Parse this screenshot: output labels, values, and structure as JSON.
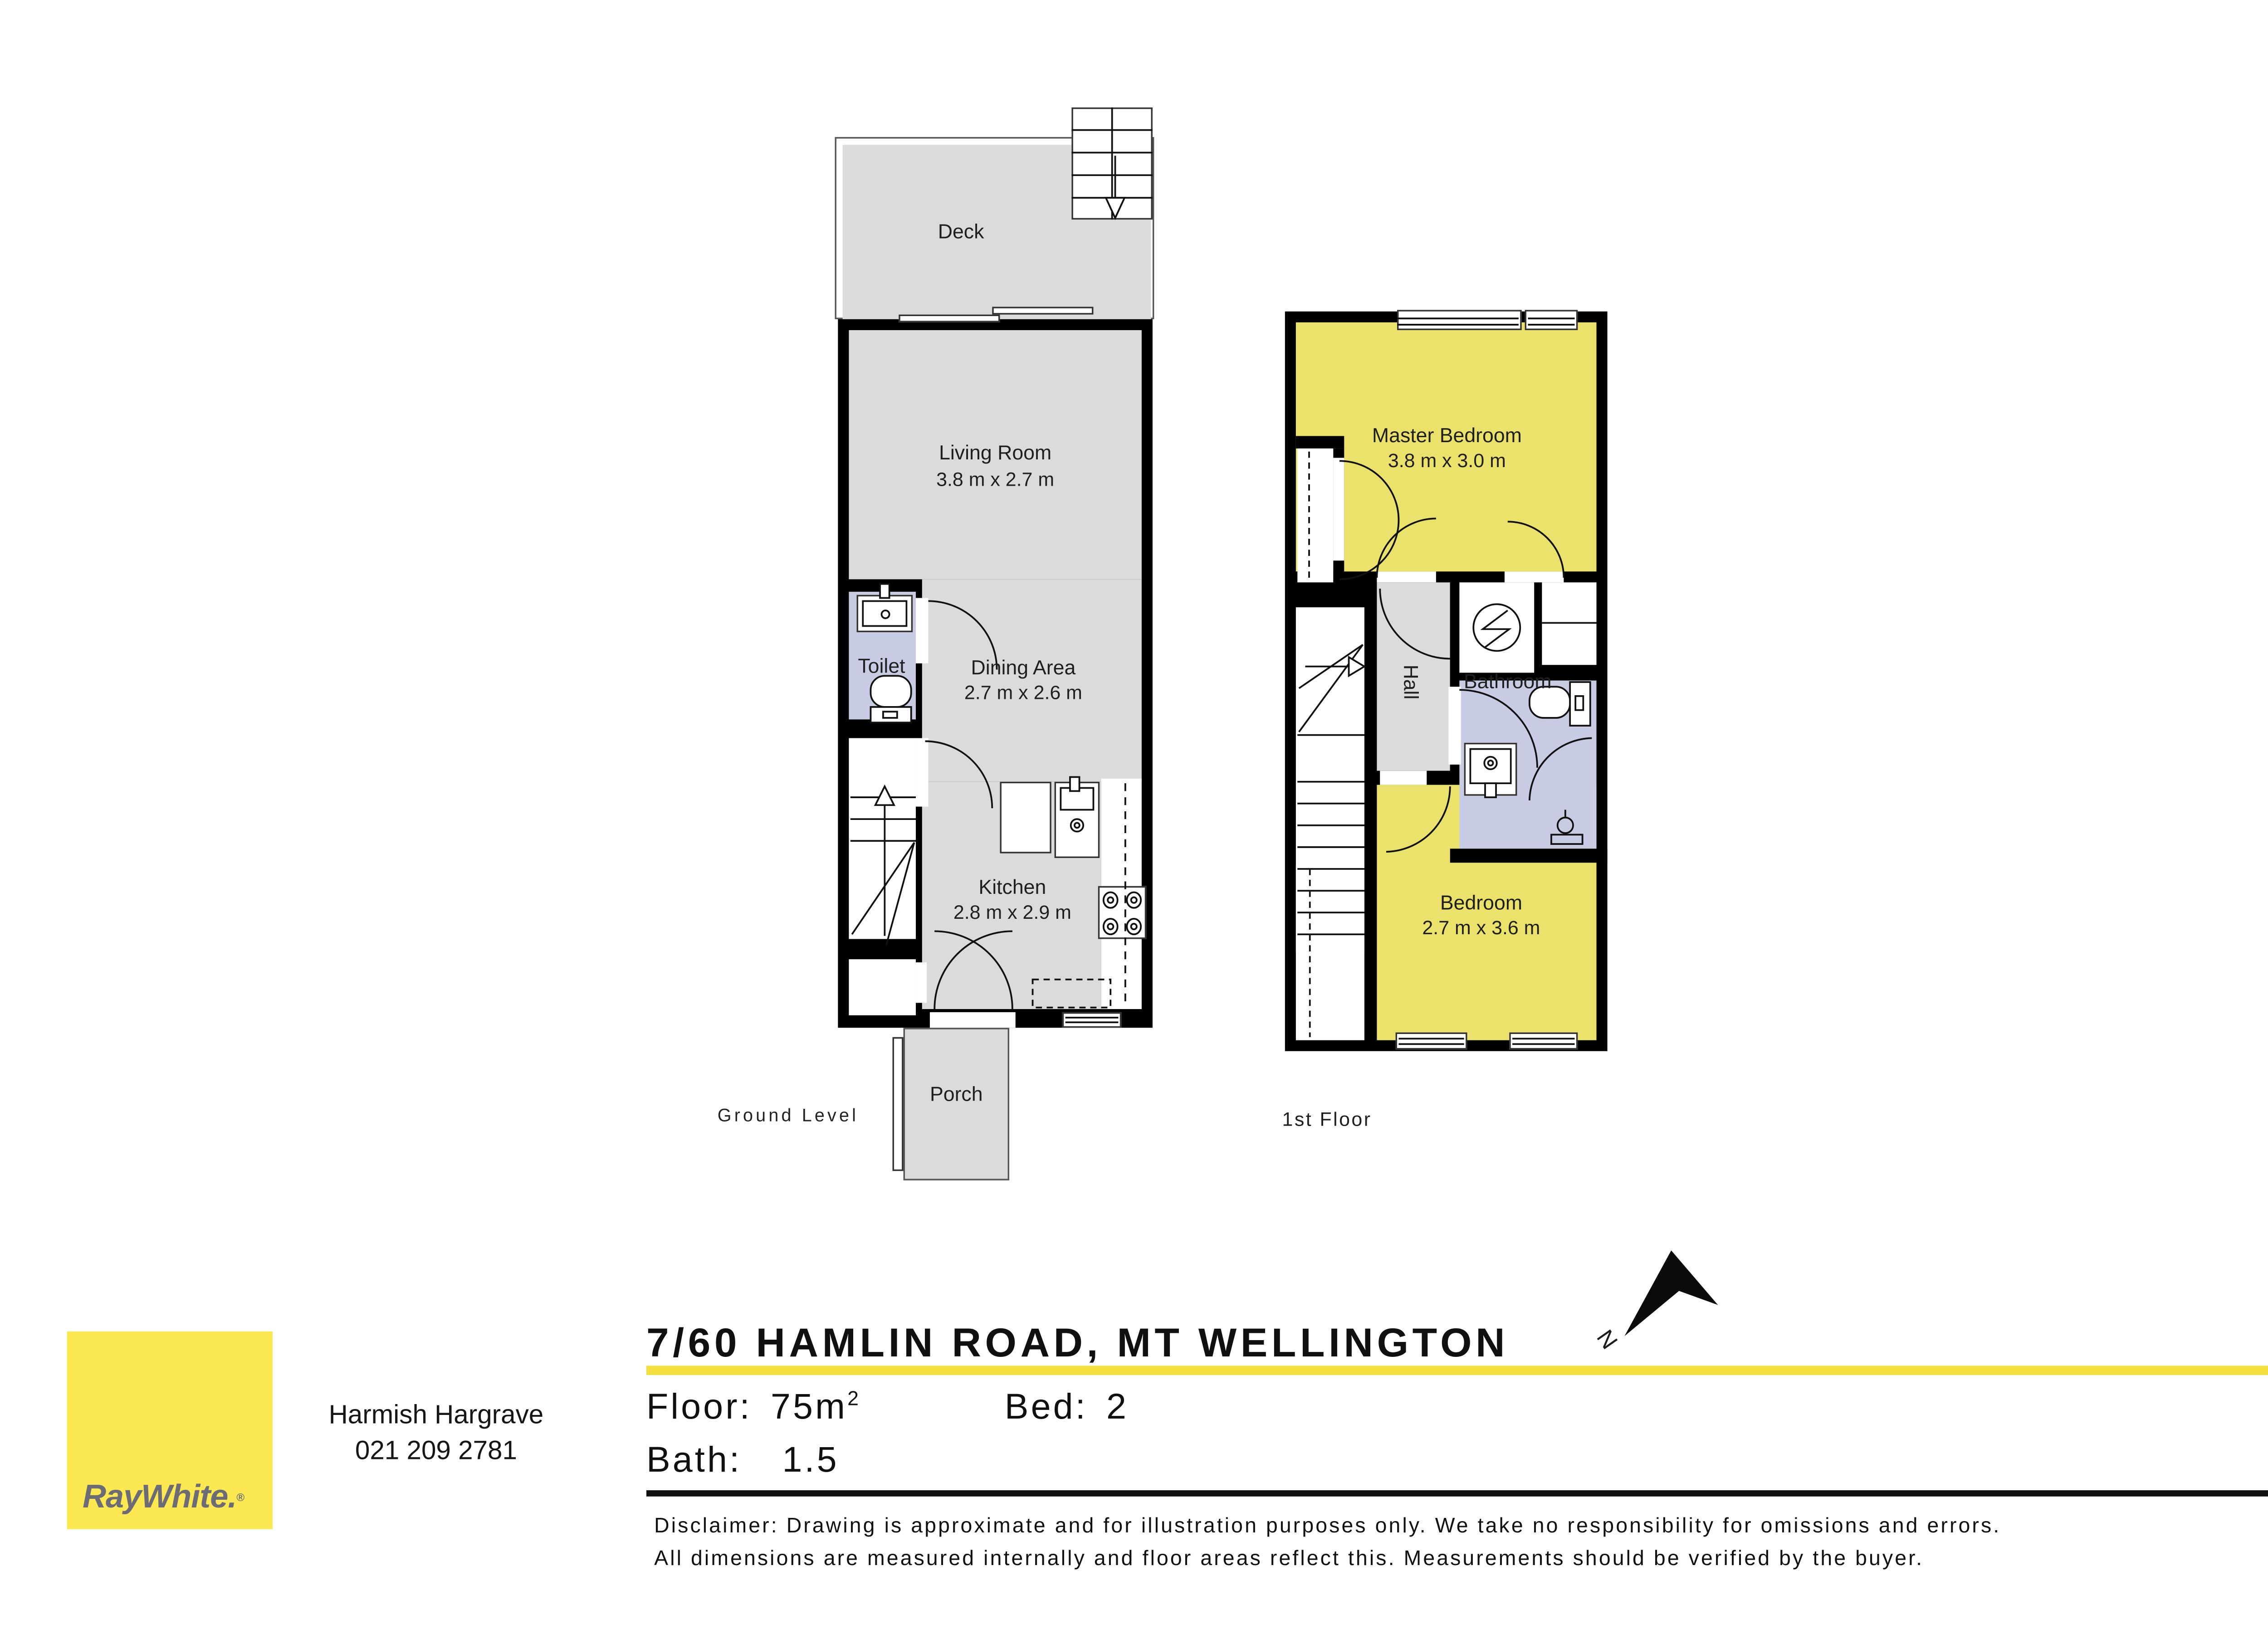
{
  "ground_floor": {
    "label": "Ground Level",
    "rooms": {
      "deck": {
        "name": "Deck"
      },
      "living": {
        "name": "Living Room",
        "dims": "3.8 m x 2.7 m"
      },
      "toilet": {
        "name": "Toilet"
      },
      "dining": {
        "name": "Dining Area",
        "dims": "2.7 m x 2.6 m"
      },
      "kitchen": {
        "name": "Kitchen",
        "dims": "2.8 m x 2.9 m"
      },
      "porch": {
        "name": "Porch"
      }
    }
  },
  "first_floor": {
    "label": "1st Floor",
    "rooms": {
      "master": {
        "name": "Master Bedroom",
        "dims": "3.8 m x 3.0 m"
      },
      "hall": {
        "name": "Hall"
      },
      "bathroom": {
        "name": "Bathroom"
      },
      "bedroom": {
        "name": "Bedroom",
        "dims": "2.7 m x 3.6 m"
      }
    }
  },
  "listing": {
    "address": "7/60 HAMLIN ROAD, MT WELLINGTON",
    "north_label": "N",
    "stats": {
      "floor_label": "Floor:",
      "floor_value": "75m",
      "floor_sup": "2",
      "bed_label": "Bed:",
      "bed_value": "2",
      "bath_label": "Bath:",
      "bath_value": "1.5"
    }
  },
  "agent": {
    "name": "Harmish Hargrave",
    "phone": "021 209 2781"
  },
  "brand": {
    "logo_text": "RayWhite",
    "logo_suffix": ".",
    "logo_reg": "®"
  },
  "disclaimer": {
    "line1": "Disclaimer: Drawing is approximate and for illustration purposes only. We take no responsibility for omissions and errors.",
    "line2": "All dimensions are measured internally and floor areas reflect this. Measurements should be verified by the buyer."
  },
  "colors": {
    "wall": "#000000",
    "floor_gray": "#dbdbdb",
    "room_yellow": "#ebe26c",
    "wet_room_lavender": "#c8cce2",
    "brand_yellow": "#fce851",
    "underline_yellow": "#f3e03c",
    "logo_text_gray": "#6c6c77"
  }
}
